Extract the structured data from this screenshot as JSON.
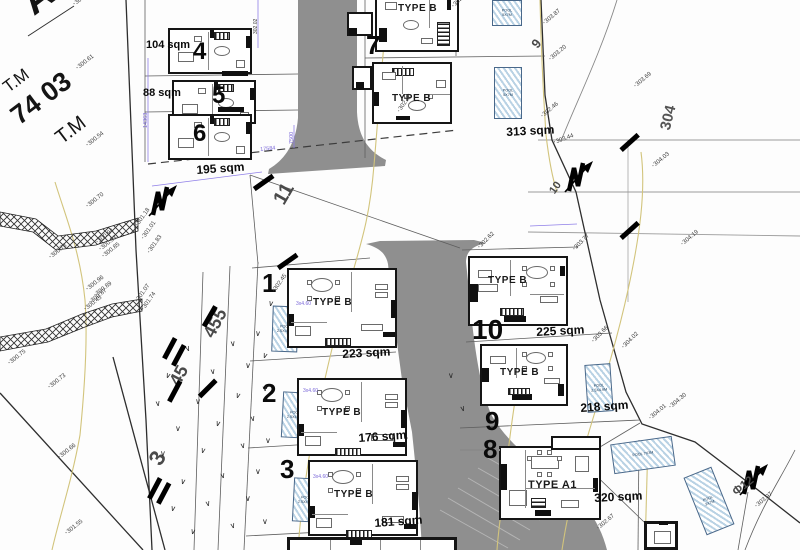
{
  "sheet": {
    "street_name": "ΑΙΟΥ",
    "tm_label_1": "T.M",
    "block_number": "74 03",
    "tm_label_2": "T.M",
    "refs": {
      "r11": "11",
      "r304": "304",
      "r455": "455",
      "r45": "45",
      "r3": "3",
      "r9": "9",
      "r10": "10",
      "rf12": "Φ12"
    }
  },
  "plots": {
    "p1": {
      "no": "1",
      "type": "TYPE B",
      "area": "223 sqm"
    },
    "p2": {
      "no": "2",
      "type": "TYPE B",
      "area": "176 sqm"
    },
    "p3": {
      "no": "3",
      "type": "TYPE B",
      "area": "181 sqm"
    },
    "p4": {
      "no": "4",
      "area": "104 sqm"
    },
    "p5": {
      "no": "5",
      "area": "88 sqm"
    },
    "p6": {
      "no": "6",
      "area": "195 sqm"
    },
    "p7": {
      "no": "7",
      "type": "TYPE B",
      "area": "313 sqm"
    },
    "p7u": {
      "type": "TYPE B"
    },
    "p8": {
      "no": "8",
      "type": "TYPE A1",
      "area": "320 sqm"
    },
    "p9": {
      "no": "9",
      "type": "TYPE B",
      "area": "218 sqm"
    },
    "p10": {
      "no": "10",
      "type": "TYPE B",
      "area": "225 sqm"
    }
  },
  "pools": {
    "pool_5x7": "POOL 5X7M",
    "pool_small": "POOL 2.5X4.9M",
    "pool_7x3": "POOL 7X3M",
    "pool_3x7": "POOL 3X7M"
  },
  "dimensions": {
    "d1": "14363",
    "d2": "17584",
    "d3": "7500",
    "d4": "3x4.60",
    "d5": "302.02"
  },
  "spot_heights": [
    {
      "x": 74,
      "y": 2,
      "r": -38,
      "v": "303.68"
    },
    {
      "x": 77,
      "y": 66,
      "r": -38,
      "v": "300.61"
    },
    {
      "x": 87,
      "y": 143,
      "r": -38,
      "v": "300.54"
    },
    {
      "x": 87,
      "y": 204,
      "r": -38,
      "v": "300.70"
    },
    {
      "x": 50,
      "y": 255,
      "r": -38,
      "v": "300.78"
    },
    {
      "x": 97,
      "y": 240,
      "r": -38,
      "v": "300.94"
    },
    {
      "x": 100,
      "y": 247,
      "r": -38,
      "v": "300.93"
    },
    {
      "x": 103,
      "y": 254,
      "r": -38,
      "v": "300.85"
    },
    {
      "x": 137,
      "y": 223,
      "r": -55,
      "v": "301.18"
    },
    {
      "x": 143,
      "y": 236,
      "r": -55,
      "v": "301.01"
    },
    {
      "x": 149,
      "y": 250,
      "r": -55,
      "v": "301.83"
    },
    {
      "x": 87,
      "y": 287,
      "r": -38,
      "v": "300.96"
    },
    {
      "x": 95,
      "y": 293,
      "r": -38,
      "v": "300.89"
    },
    {
      "x": 90,
      "y": 300,
      "r": -38,
      "v": "300.87"
    },
    {
      "x": 85,
      "y": 307,
      "r": -38,
      "v": "300.45"
    },
    {
      "x": 137,
      "y": 299,
      "r": -55,
      "v": "301.07"
    },
    {
      "x": 143,
      "y": 307,
      "r": -55,
      "v": "301.74"
    },
    {
      "x": 9,
      "y": 361,
      "r": -38,
      "v": "300.75"
    },
    {
      "x": 49,
      "y": 385,
      "r": -38,
      "v": "300.73"
    },
    {
      "x": 59,
      "y": 455,
      "r": -38,
      "v": "300.66"
    },
    {
      "x": 66,
      "y": 531,
      "r": -38,
      "v": "301.55"
    },
    {
      "x": 274,
      "y": 289,
      "r": -55,
      "v": "302.45"
    },
    {
      "x": 399,
      "y": 109,
      "r": -55,
      "v": "302.80"
    },
    {
      "x": 453,
      "y": 4,
      "r": -45,
      "v": "302.40"
    },
    {
      "x": 544,
      "y": 21,
      "r": -40,
      "v": "303.87"
    },
    {
      "x": 550,
      "y": 57,
      "r": -40,
      "v": "303.20"
    },
    {
      "x": 635,
      "y": 84,
      "r": -40,
      "v": "303.69"
    },
    {
      "x": 542,
      "y": 114,
      "r": -40,
      "v": "302.46"
    },
    {
      "x": 554,
      "y": 140,
      "r": -20,
      "v": "303.44"
    },
    {
      "x": 653,
      "y": 164,
      "r": -40,
      "v": "304.03"
    },
    {
      "x": 682,
      "y": 242,
      "r": -40,
      "v": "304.19"
    },
    {
      "x": 593,
      "y": 339,
      "r": -45,
      "v": "303.66"
    },
    {
      "x": 623,
      "y": 345,
      "r": -45,
      "v": "304.02"
    },
    {
      "x": 574,
      "y": 247,
      "r": -45,
      "v": "303.77"
    },
    {
      "x": 479,
      "y": 245,
      "r": -45,
      "v": "302.62"
    },
    {
      "x": 650,
      "y": 416,
      "r": -40,
      "v": "304.01"
    },
    {
      "x": 670,
      "y": 405,
      "r": -40,
      "v": "304.30"
    },
    {
      "x": 598,
      "y": 526,
      "r": -40,
      "v": "302.67"
    },
    {
      "x": 756,
      "y": 504,
      "r": -40,
      "v": "303.97"
    }
  ],
  "colors": {
    "road": "#8f8f8f",
    "contour": "#d2c47c",
    "pool_fill": "#b9d2e4",
    "hatch": "#333333"
  }
}
